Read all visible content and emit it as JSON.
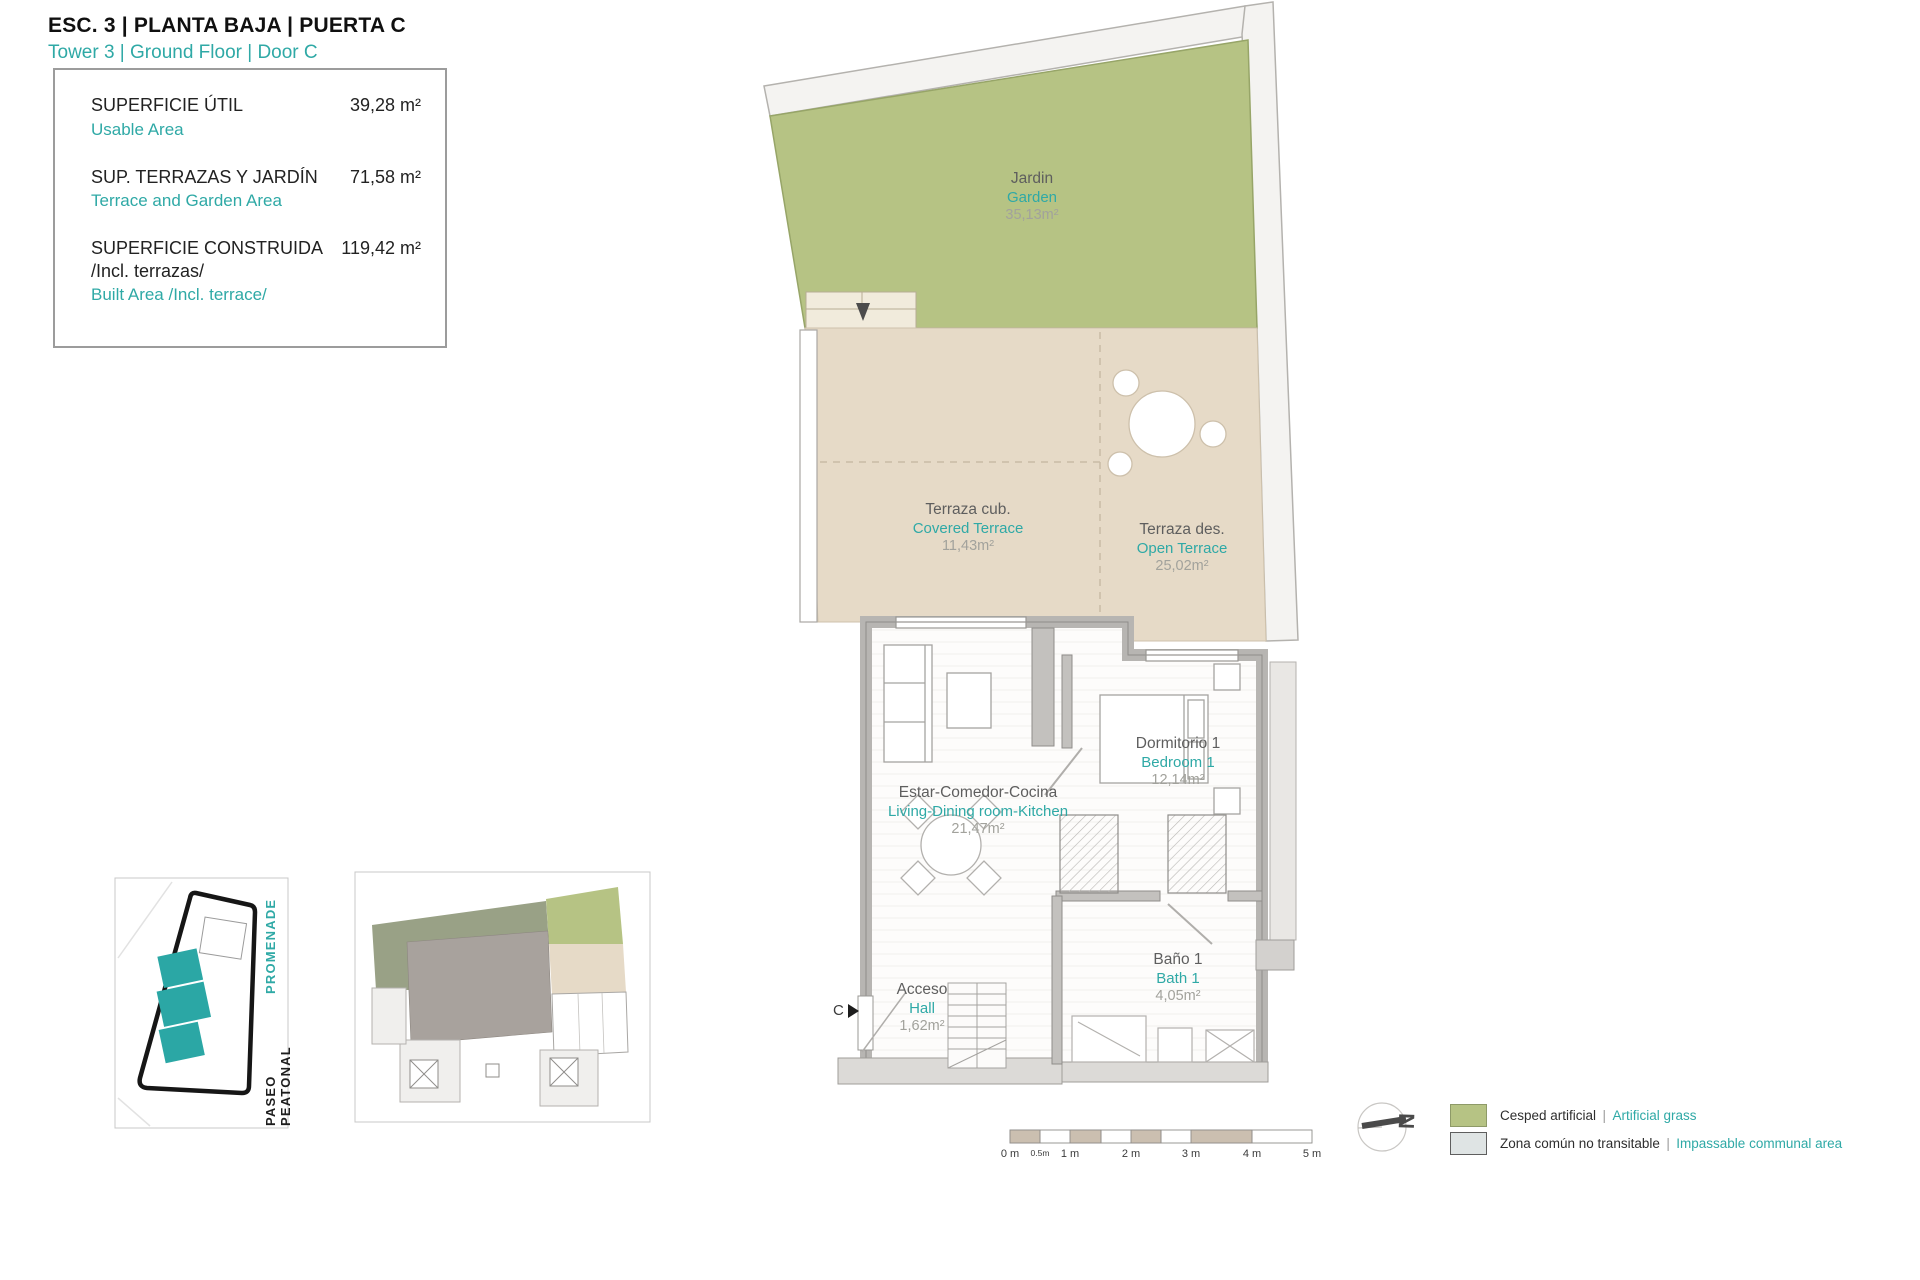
{
  "header": {
    "title": "ESC. 3 | PLANTA BAJA | PUERTA C",
    "subtitle": "Tower 3 | Ground Floor | Door C"
  },
  "area_box": {
    "rows": [
      {
        "label_es": "SUPERFICIE ÚTIL",
        "label_en": "Usable Area",
        "value": "39,28 m²"
      },
      {
        "label_es": "SUP. TERRAZAS Y JARDÍN",
        "label_en": "Terrace and Garden Area",
        "value": "71,58 m²"
      },
      {
        "label_es": "SUPERFICIE CONSTRUIDA",
        "label_es2": "/Incl. terrazas/",
        "label_en": "Built Area /Incl. terrace/",
        "value": "119,42 m²"
      }
    ]
  },
  "rooms": [
    {
      "name_es": "Jardin",
      "name_en": "Garden",
      "area": "35,13m²"
    },
    {
      "name_es": "Terraza cub.",
      "name_en": "Covered Terrace",
      "area": "11,43m²"
    },
    {
      "name_es": "Terraza des.",
      "name_en": "Open Terrace",
      "area": "25,02m²"
    },
    {
      "name_es": "Estar-Comedor-Cocina",
      "name_en": "Living-Dining room-Kitchen",
      "area": "21,47m²"
    },
    {
      "name_es": "Dormitorio 1",
      "name_en": "Bedroom 1",
      "area": "12,14m²"
    },
    {
      "name_es": "Baño 1",
      "name_en": "Bath 1",
      "area": "4,05m²"
    },
    {
      "name_es": "Acceso",
      "name_en": "Hall",
      "area": "1,62m²"
    }
  ],
  "door_marker": {
    "letter": "C"
  },
  "site_plan": {
    "street_es": "PASEO PEATONAL",
    "street_en": "PROMENADE"
  },
  "scale_bar": {
    "labels": [
      "0 m",
      "0.5m",
      "1 m",
      "2 m",
      "3 m",
      "4 m",
      "5 m"
    ]
  },
  "compass": {
    "letter": "N"
  },
  "legend": {
    "separator": "|",
    "rows": [
      {
        "label_es": "Cesped artificial",
        "label_en": "Artificial grass",
        "swatch_color": "#b6c384"
      },
      {
        "label_es": "Zona común no transitable",
        "label_en": "Impassable communal area",
        "swatch_color": "#dfe4e4"
      }
    ]
  },
  "colors": {
    "accent_teal": "#2fa9a6",
    "garden_green": "#b6c384",
    "terrace_tan": "#e6dac7",
    "wall_gray": "#b7b5b2"
  }
}
